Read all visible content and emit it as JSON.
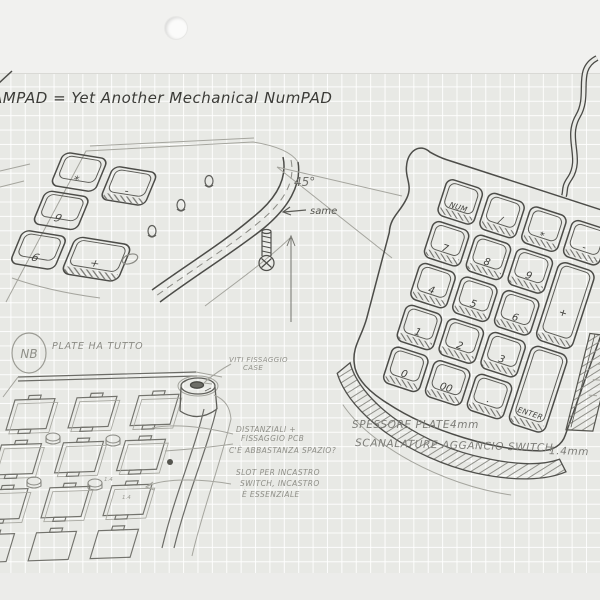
{
  "colors": {
    "paper_grid": "#e8e9e5",
    "paper_margin": "#f1f1ef",
    "grid_line": "#ffffff",
    "pencil_dark": "#4a4a46",
    "pencil_mid": "#6f6f6a",
    "pencil_light": "#97978f"
  },
  "title": "AMPAD = Yet Another Mechanical NumPAD",
  "top_sketch": {
    "angle_label": "45°",
    "same_label": "same",
    "keys": [
      "*",
      "-",
      "9",
      "+",
      "6"
    ]
  },
  "numpad_sketch": {
    "keys": [
      "NUM",
      "/",
      "*",
      "-",
      "7",
      "8",
      "9",
      "+",
      "4",
      "5",
      "6",
      "1",
      "2",
      "3",
      "ENTER",
      "0",
      "00",
      "."
    ]
  },
  "plate_sketch": {
    "nb_label": "NB",
    "note": "PLATE HA TUTTO",
    "dim_a": "1.4",
    "dim_b": "1.4"
  },
  "annotations": {
    "viti_1": "VITI FISSAGGIO",
    "viti_2": "CASE",
    "dist_1": "DISTANZIALI +",
    "dist_2": "FISSAGGIO PCB",
    "dist_3": "C'È ABBASTANZA SPAZIO?",
    "slot_1": "SLOT PER INCASTRO",
    "slot_2": "SWITCH, INCASTRO",
    "slot_3": "È ESSENZIALE",
    "spessore_label": "SPESSORE PLATE",
    "spessore_value": "4mm",
    "scanalature_label": "SCANALATURE AGGANCIO SWITCH",
    "scanalature_value": "1.4mm"
  }
}
